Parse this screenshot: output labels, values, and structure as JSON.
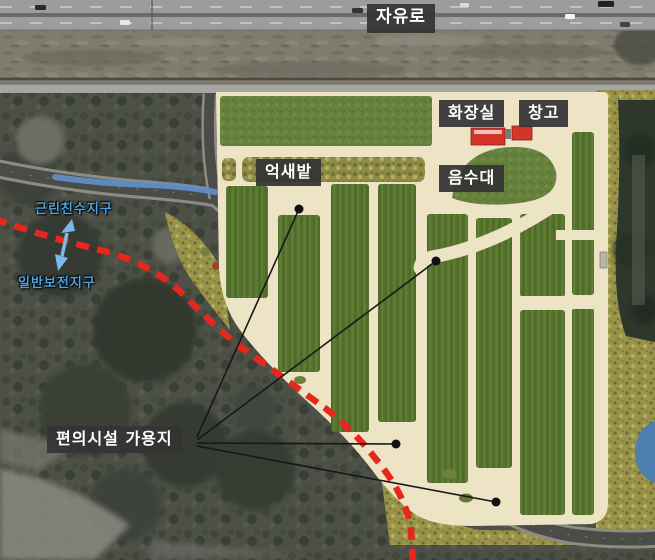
{
  "labels": {
    "highway": {
      "text": "자유로"
    },
    "restroom": {
      "text": "화장실"
    },
    "storage": {
      "text": "창고"
    },
    "silvergrass_field": {
      "text": "억새밭"
    },
    "drinking_fountain": {
      "text": "음수대"
    },
    "zone_neighborhood_waterfront": {
      "text": "근린친수지구"
    },
    "zone_general_preservation": {
      "text": "일반보전지구"
    },
    "facility_available_land": {
      "text": "편의시설 가용지"
    }
  },
  "colors": {
    "label_text": "#ffffff",
    "label_box_bg": "#343434",
    "zone_label_text": "#4fa3e2",
    "boundary_dashed": "#e5271d",
    "stream_highlight": "#5f8fc9",
    "arrow_blue": "#7cb9e8",
    "path_cream": "#ece4c4",
    "field_green": "#57742f",
    "lawn_green": "#67823e",
    "hedge_olive": "#8f8c48",
    "scrub_khaki": "#999449",
    "building_red": "#d5342a",
    "pond_blue": "#4f7fae",
    "road_dark": "#4b4b48",
    "marsh_dark": "#4c5046"
  }
}
